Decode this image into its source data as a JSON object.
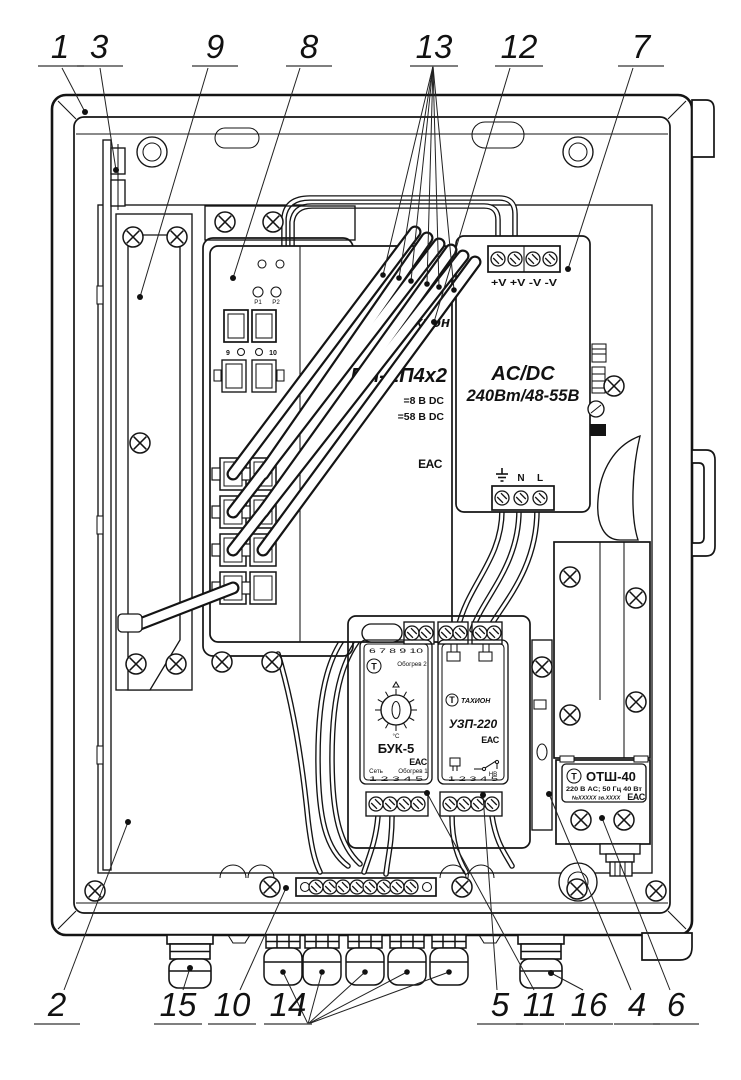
{
  "callouts": {
    "top": [
      "1",
      "3",
      "9",
      "8",
      "13",
      "12",
      "7"
    ],
    "bottom": [
      "2",
      "15",
      "10",
      "14",
      "5",
      "11",
      "16",
      "4",
      "6"
    ]
  },
  "switch": {
    "logo": "Тахион",
    "model": "ПИ-ЕП4х2",
    "dc_line1": "=8 В DC",
    "dc_line2": "=58 В DC",
    "cert": "EAC",
    "led1": "P1",
    "led2": "P2",
    "port_left": "9",
    "port_right": "10"
  },
  "psu": {
    "line1": "AC/DC",
    "line2": "240Вт/48-55В",
    "top_terminals": "+V +V -V -V",
    "n": "N",
    "l": "L"
  },
  "buk": {
    "model": "БУК-5",
    "logo_letter": "Т",
    "top_terms": "6 7 8 9 10",
    "bottom_terms": "1 2 3 4 5",
    "heat2": "Обогрев 2",
    "net": "Сеть",
    "heat1": "Обогрев 1",
    "unit": "°C",
    "cert": "EAC"
  },
  "uzp": {
    "model": "УЗП-220",
    "logo_letter": "Т",
    "logo": "ТАХИОН",
    "bottom_terms": "1 2 3 4 5",
    "relay": "НВ",
    "cert": "EAC"
  },
  "otsh": {
    "model": "ОТШ-40",
    "logo_letter": "Т",
    "spec": "220 В AC; 50 Гц 40 Вт",
    "serial": "№ХХХХХ зв.ХХХХ",
    "cert": "EAC"
  }
}
